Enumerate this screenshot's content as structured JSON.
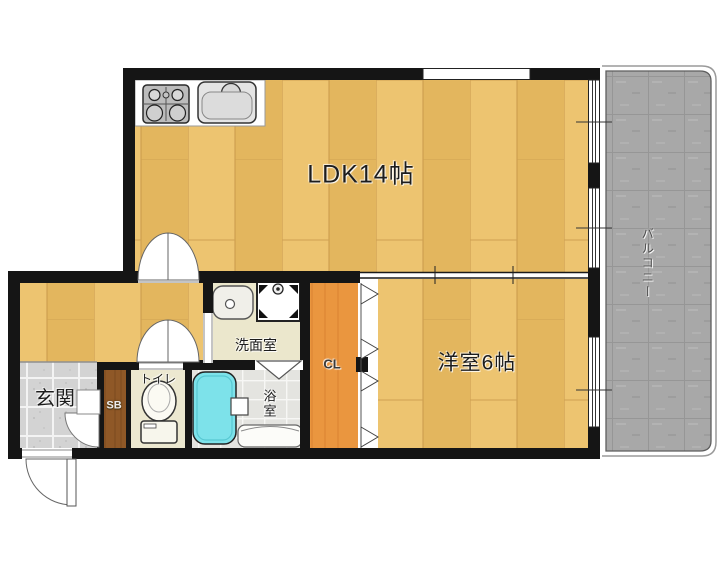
{
  "rooms": {
    "ldk": {
      "label": "LDK14帖"
    },
    "western": {
      "label": "洋室6帖"
    },
    "entrance": {
      "label": "玄関"
    },
    "toilet": {
      "label": "トイレ"
    },
    "washroom": {
      "label": "洗面室"
    },
    "bath": {
      "label": "浴室"
    },
    "closet": {
      "label": "CL"
    },
    "shoebox": {
      "label": "SB"
    },
    "balcony": {
      "label": "バルコニー"
    }
  },
  "fixtures": {
    "stove": "gas-stove-icon",
    "kitchen_sink": "kitchen-sink-icon",
    "vanity": "vanity-sink-icon",
    "washer": "washing-machine-icon",
    "toilet": "toilet-icon",
    "bathtub": "bathtub-icon",
    "doors": "door-swing-icons"
  },
  "colors": {
    "wall": "#151515",
    "wood_floor_light": "#edc470",
    "wood_floor_dark": "#e3b65e",
    "closet_orange": "#ea963f",
    "shoebox_brown": "#8f5827",
    "entrance_tile": "#d3d3d3",
    "toilet_floor": "#ece8d0",
    "washroom_floor": "#ebe7cc",
    "bathroom_tile": "#e4e4e0",
    "bathtub_cyan": "#7de2ea",
    "balcony_gray": "#a8a8a8",
    "background": "#ffffff"
  }
}
